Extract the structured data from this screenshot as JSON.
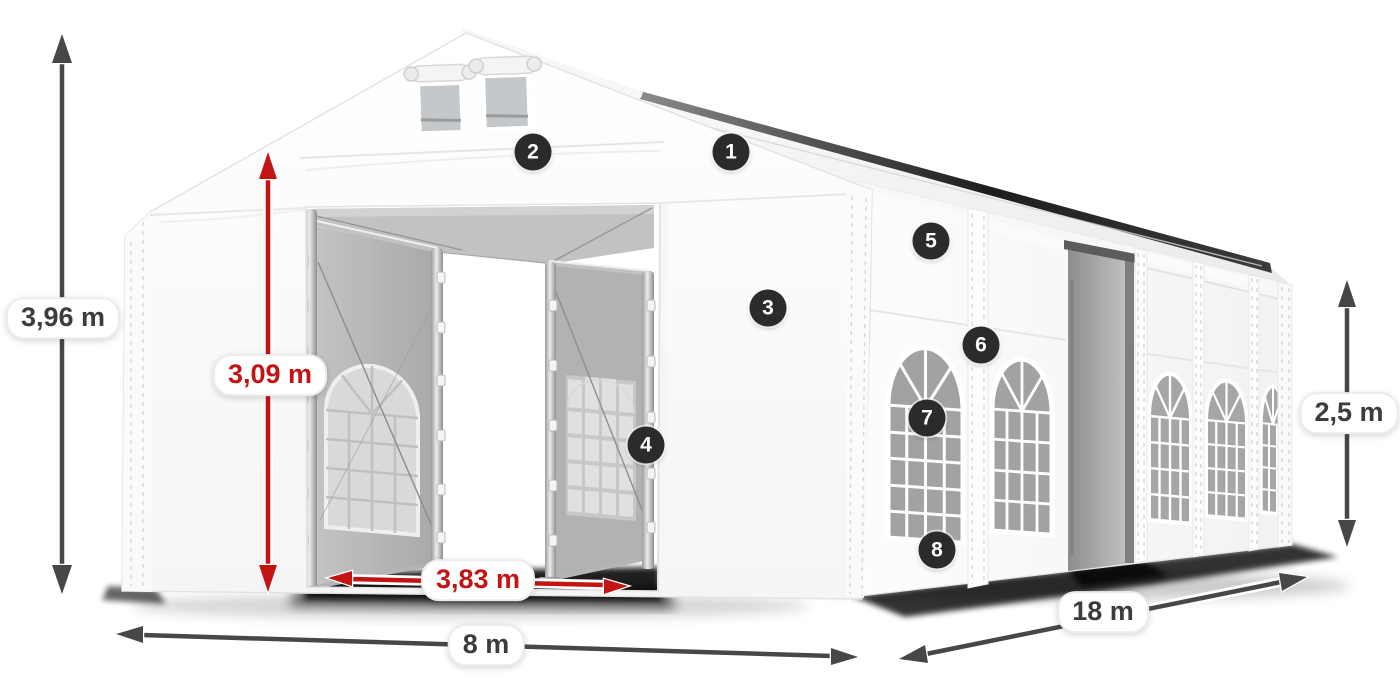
{
  "dimensions": {
    "total_height": "3,96 m",
    "entrance_height": "3,09 m",
    "entrance_width": "3,83 m",
    "gable_width": "8 m",
    "length": "18 m",
    "side_wall_height": "2,5 m"
  },
  "markers": [
    "1",
    "2",
    "3",
    "4",
    "5",
    "6",
    "7",
    "8"
  ],
  "colors": {
    "dimension_arrow": "#474747",
    "dimension_text": "#3c3c3c",
    "highlight_arrow": "#c31414",
    "marker_background": "#2b2b2b",
    "marker_text": "#ffffff",
    "canvas_background": "#ffffff"
  }
}
